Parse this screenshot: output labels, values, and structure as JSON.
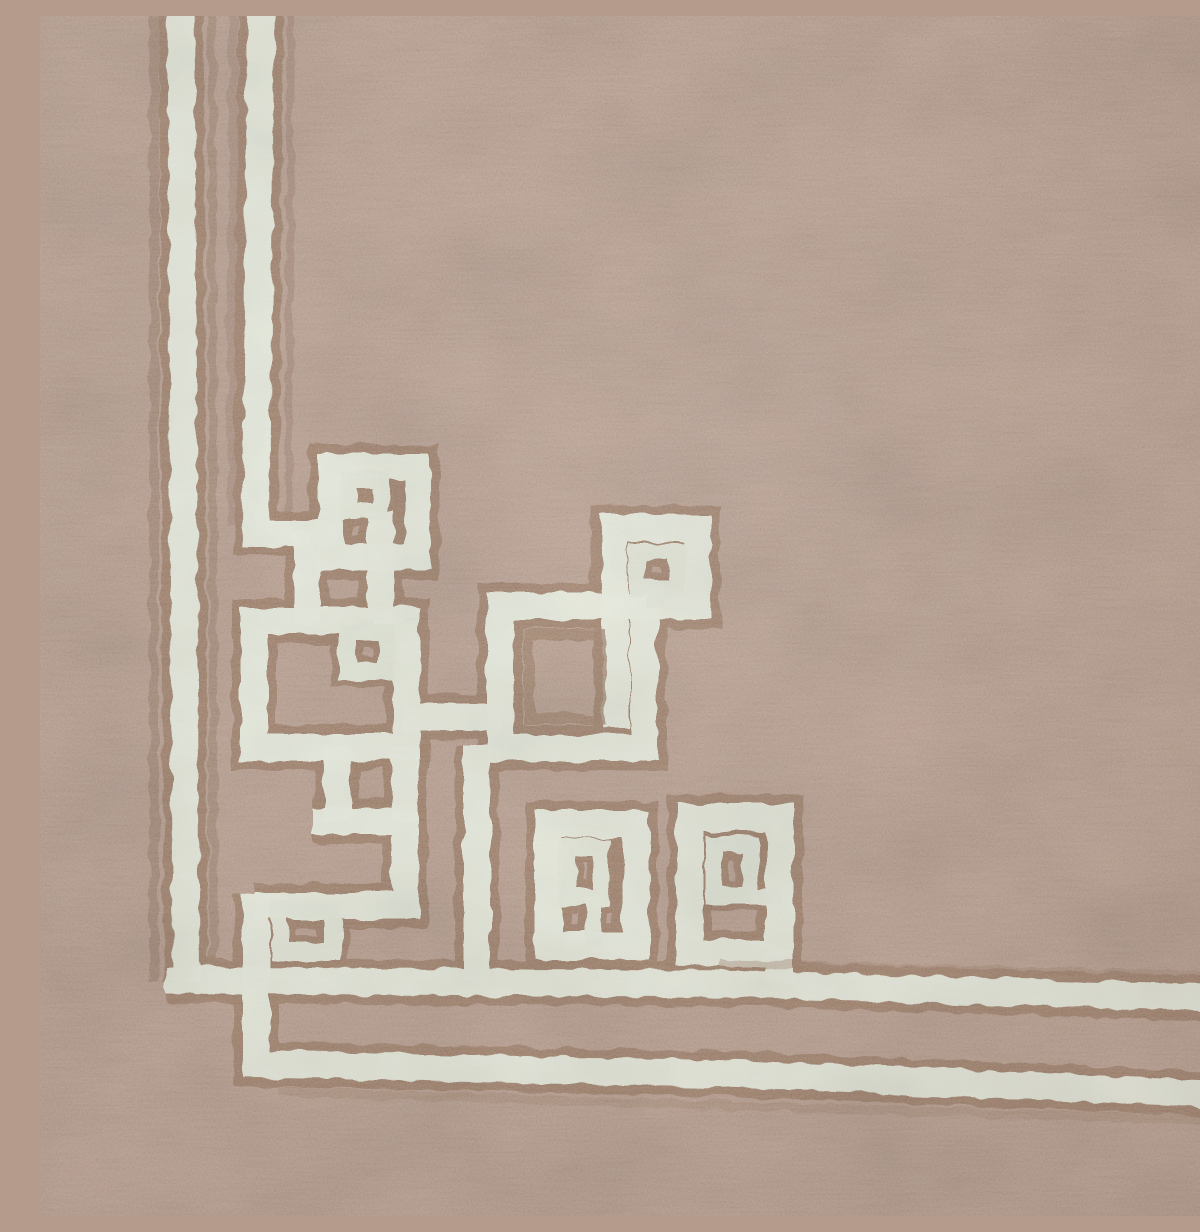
{
  "scene": {
    "type": "photograph",
    "subject": "close-up corner detail of a flat-woven wool dhurrie rug",
    "alt": "Taupe woven rug corner with an ivory Greek-key fretwork border of interlocking squares outlined in brown",
    "description": "Two ivory border stripes run down the left edge and two run along the bottom edge; at the corner they join an ornament of interlocking square key motifs (small squares nested inside larger ones) embroidered in ivory with tan-brown shadow outlines on a pinkish-taupe ground."
  },
  "palette": {
    "background": "#b59b8c",
    "cream": "#e8ecdd",
    "cream_soft": "#e3e8d8",
    "brown_edge": "#9b7d66",
    "brown_streak": "#8f7360"
  },
  "pattern": {
    "stroke_widths": {
      "cream": 27,
      "brown": 45,
      "inner_cream": 17,
      "inner_brown": 31
    },
    "paths": [
      {
        "name": "left-edge-brown-streak",
        "kind": "brown-under",
        "d": "M 114,-30 L 114,966",
        "w": 9,
        "o": 0.5
      },
      {
        "name": "stripe-gap-brown-streak",
        "kind": "brown-under",
        "d": "M 172,-30 L 174,960",
        "w": 8,
        "o": 0.45
      },
      {
        "name": "stripe-gap-brown-streak-2",
        "kind": "brown-under",
        "d": "M 193,-30 L 191,508",
        "w": 9,
        "o": 0.35
      },
      {
        "name": "inner-stripe-brown-streak",
        "kind": "brown-under",
        "d": "M 251,-30 L 249,502",
        "w": 8,
        "o": 0.4
      },
      {
        "name": "outer-left-stripe",
        "kind": "woven-line",
        "d": "M 141,-30 L 146,966"
      },
      {
        "name": "bottom-inner-line",
        "kind": "woven-line",
        "d": "M 126,964 L 700,968 L 1230,984"
      },
      {
        "name": "corner-step-and-bottom-outer-line",
        "kind": "woven-line",
        "d": "M 216,878 L 216,1048 L 700,1058 L 1230,1080"
      },
      {
        "name": "inner-left-stripe",
        "kind": "woven-line",
        "d": "M 221,-30 L 216,517 L 296,517"
      },
      {
        "name": "key-a-ring",
        "kind": "woven-line",
        "d": "M 291,450 L 377,450 L 377,541 L 291,541 Z"
      },
      {
        "name": "key-a-left-connector",
        "kind": "woven-line",
        "d": "M 267,515 L 267,610"
      },
      {
        "name": "key-a-stub-connector",
        "kind": "woven-line",
        "d": "M 341,496 L 341,610"
      },
      {
        "name": "key-b-ring",
        "kind": "woven-line",
        "d": "M 214,605 L 366,605 L 366,731 L 214,731 Z"
      },
      {
        "name": "connector-b-c",
        "kind": "woven-line",
        "d": "M 364,701 L 462,701"
      },
      {
        "name": "connector-b-e",
        "kind": "woven-line",
        "d": "M 297,729 L 297,806"
      },
      {
        "name": "square-c-ring",
        "kind": "woven-line",
        "d": "M 460,590 L 604,590 L 604,732 L 460,732 Z"
      },
      {
        "name": "c-drop-line",
        "kind": "woven-line",
        "d": "M 437,729 L 437,966"
      },
      {
        "name": "key-d-ring",
        "kind": "woven-line",
        "d": "M 574,590 L 574,512 L 658,512 L 658,590 Z"
      },
      {
        "name": "d-inner-stem",
        "kind": "woven-line",
        "d": "M 576,588 L 576,712"
      },
      {
        "name": "key-e-spiral",
        "kind": "woven-line",
        "d": "M 214,890 L 365,890 L 365,805 L 273,805"
      },
      {
        "name": "e-top-riser",
        "kind": "woven-line",
        "d": "M 365,806 L 365,729"
      },
      {
        "name": "key-f1-ring",
        "kind": "woven-line",
        "d": "M 508,808 L 596,808 L 596,930 L 508,930 Z"
      },
      {
        "name": "key-f2-ring",
        "kind": "woven-line",
        "d": "M 650,801 L 740,801 L 740,937 L 650,937 Z"
      },
      {
        "name": "f2-drop",
        "kind": "woven-line",
        "d": "M 740,935 L 740,966"
      },
      {
        "name": "key-b-inner-stub",
        "kind": "woven-line-inner",
        "d": "M 327,603 L 327,620"
      },
      {
        "name": "f1-inner-stub",
        "kind": "woven-line-inner",
        "d": "M 553,881 L 553,930"
      },
      {
        "name": "f2-inner-stub",
        "kind": "woven-line-inner",
        "d": "M 710,880 L 742,880"
      },
      {
        "name": "d-inner-stub",
        "kind": "woven-line-inner",
        "d": "M 617,572 L 617,592"
      },
      {
        "name": "key-a-inner-ring",
        "kind": "woven-line-inner",
        "d": "M 309,464 L 341,464 L 341,496 L 309,496 Z"
      },
      {
        "name": "key-b-inner-ring",
        "kind": "woven-line-inner",
        "d": "M 307,616 L 347,616 L 347,656 L 307,656 Z"
      },
      {
        "name": "key-d-inner-ring",
        "kind": "woven-line-inner",
        "d": "M 597,536 L 637,536 L 637,572 L 597,572 Z"
      },
      {
        "name": "key-e-inner-ring",
        "kind": "woven-line-inner",
        "d": "M 240,893 L 293,893 L 293,936 L 240,936 Z"
      },
      {
        "name": "key-f1-inner-ring",
        "kind": "woven-line-inner",
        "d": "M 527,831 L 561,831 L 561,881 L 527,881 Z"
      },
      {
        "name": "key-f2-inner-ring",
        "kind": "woven-line-inner",
        "d": "M 674,828 L 710,828 L 710,880 L 674,880 Z"
      },
      {
        "name": "square-c-inner-brown-ring",
        "kind": "brown-over",
        "d": "M 489,619 L 560,619 L 560,703 L 489,703 Z",
        "w": 11,
        "o": 0.8
      },
      {
        "name": "bottom-inner-upper-shadow",
        "kind": "brown-over",
        "d": "M 680,948 L 1230,960",
        "w": 8,
        "o": 0.4
      },
      {
        "name": "bottom-outer-lower-shadow",
        "kind": "brown-over",
        "d": "M 240,1076 L 1230,1106",
        "w": 9,
        "o": 0.35
      }
    ]
  }
}
